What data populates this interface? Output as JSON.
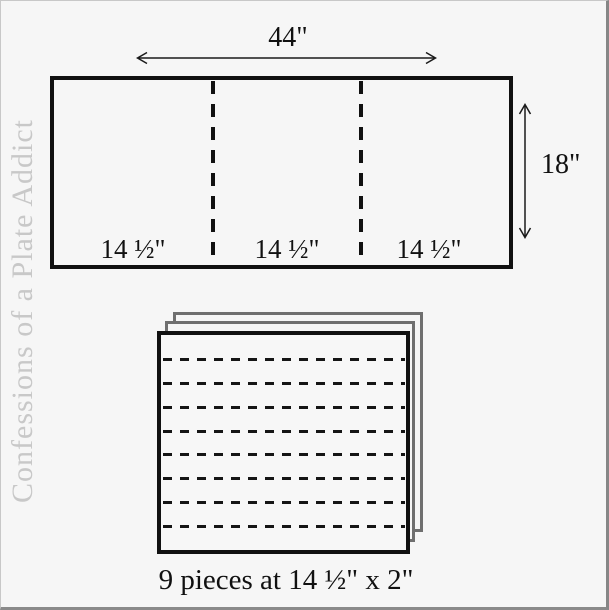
{
  "watermark": {
    "text": "Confessions of a Plate Addict",
    "color": "#c8c8c8"
  },
  "fabric_panel": {
    "width_label": "44\"",
    "height_label": "18\"",
    "section_labels": [
      "14 ½\"",
      "14 ½\"",
      "14 ½\""
    ],
    "sections": 3
  },
  "strip_stack": {
    "caption": "9 pieces at 14 ½\" x 2\"",
    "pieces": 9,
    "cut_lines": 8
  },
  "colors": {
    "background": "#f6f6f6",
    "line": "#111111",
    "sheet_edge": "#6f6f6f",
    "watermark": "#c8c8c8",
    "frame_light": "#c8c8c8",
    "frame_dark": "#868686"
  }
}
